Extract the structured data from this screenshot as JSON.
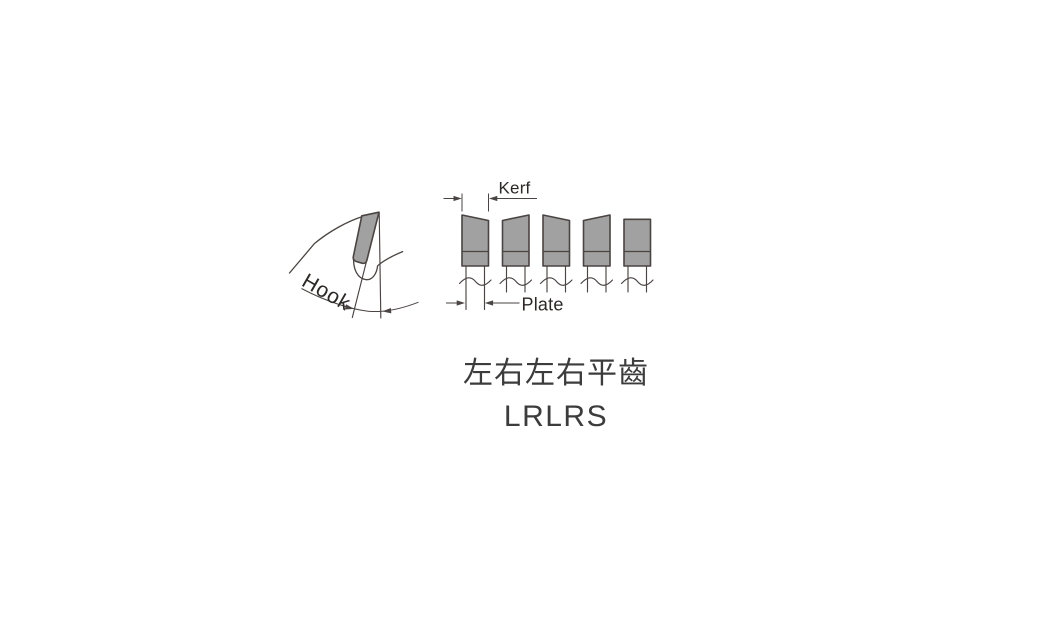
{
  "figure": {
    "hook_label": "Hook",
    "kerf_label": "Kerf",
    "plate_label": "Plate",
    "teeth_pattern": [
      "L",
      "R",
      "L",
      "R",
      "S"
    ],
    "colors": {
      "line": "#4a4442",
      "fill": "#a1a1a1",
      "ink": "#2c2826",
      "caption": "#3c3c3c",
      "background": "#ffffff"
    }
  },
  "caption": {
    "grind_name_zh": "左右左右平齒",
    "grind_code": "LRLRS"
  }
}
